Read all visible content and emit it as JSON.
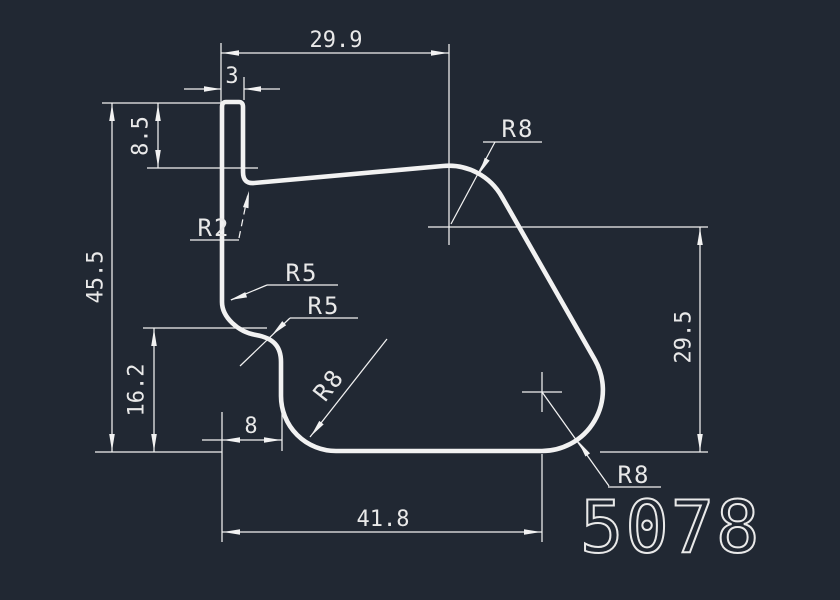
{
  "canvas": {
    "part_number": "5078",
    "colors": {
      "background": "#212833",
      "line": "#F2F2F2",
      "text": "#E9E9E9"
    }
  },
  "dimensions": {
    "top_width": "29.9",
    "tab_width": "3",
    "tab_depth": "8.5",
    "total_height": "45.5",
    "lower_left_height": "16.2",
    "lower_step_width": "8",
    "bottom_width": "41.8",
    "right_height": "29.5"
  },
  "radius_labels": {
    "top_right": "R8",
    "notch": "R2",
    "s_curve_upper": "R5",
    "s_curve_lower": "R5",
    "bottom_left": "R8",
    "bottom_right": "R8"
  }
}
